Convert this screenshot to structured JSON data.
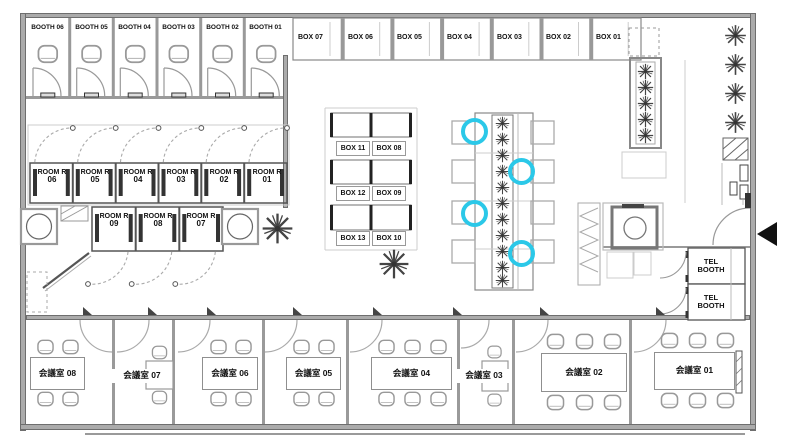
{
  "booths": [
    {
      "label": "BOOTH 06"
    },
    {
      "label": "BOOTH 05"
    },
    {
      "label": "BOOTH 04"
    },
    {
      "label": "BOOTH 03"
    },
    {
      "label": "BOOTH 02"
    },
    {
      "label": "BOOTH 01"
    }
  ],
  "top_boxes": [
    {
      "label": "BOX 07"
    },
    {
      "label": "BOX 06"
    },
    {
      "label": "BOX 05"
    },
    {
      "label": "BOX 04"
    },
    {
      "label": "BOX 03"
    },
    {
      "label": "BOX 02"
    },
    {
      "label": "BOX 01"
    }
  ],
  "rooms_upper": [
    {
      "line1": "ROOM R",
      "line2": "06"
    },
    {
      "line1": "ROOM R",
      "line2": "05"
    },
    {
      "line1": "ROOM R",
      "line2": "04"
    },
    {
      "line1": "ROOM R",
      "line2": "03"
    },
    {
      "line1": "ROOM R",
      "line2": "02"
    },
    {
      "line1": "ROOM R",
      "line2": "01"
    }
  ],
  "rooms_lower": [
    {
      "line1": "ROOM R",
      "line2": "09"
    },
    {
      "line1": "ROOM R",
      "line2": "08"
    },
    {
      "line1": "ROOM R",
      "line2": "07"
    }
  ],
  "center_boxes": [
    {
      "label": "BOX 11"
    },
    {
      "label": "BOX 08"
    },
    {
      "label": "BOX 12"
    },
    {
      "label": "BOX 09"
    },
    {
      "label": "BOX 13"
    },
    {
      "label": "BOX 10"
    }
  ],
  "tel_booths": [
    {
      "line1": "TEL",
      "line2": "BOOTH"
    },
    {
      "line1": "TEL",
      "line2": "BOOTH"
    }
  ],
  "meeting_rooms": [
    {
      "label": "会議室 08"
    },
    {
      "label": "会議室 07"
    },
    {
      "label": "会議室 06"
    },
    {
      "label": "会議室 05"
    },
    {
      "label": "会議室 04"
    },
    {
      "label": "会議室 03"
    },
    {
      "label": "会議室 02"
    },
    {
      "label": "会議室 01"
    }
  ],
  "highlights": {
    "color": "#2BC8E8",
    "count": 4
  },
  "colors": {
    "wall": "#ababab",
    "line": "#555555",
    "light_line": "#bbbbbb",
    "highlight": "#2BC8E8",
    "background": "#ffffff"
  }
}
